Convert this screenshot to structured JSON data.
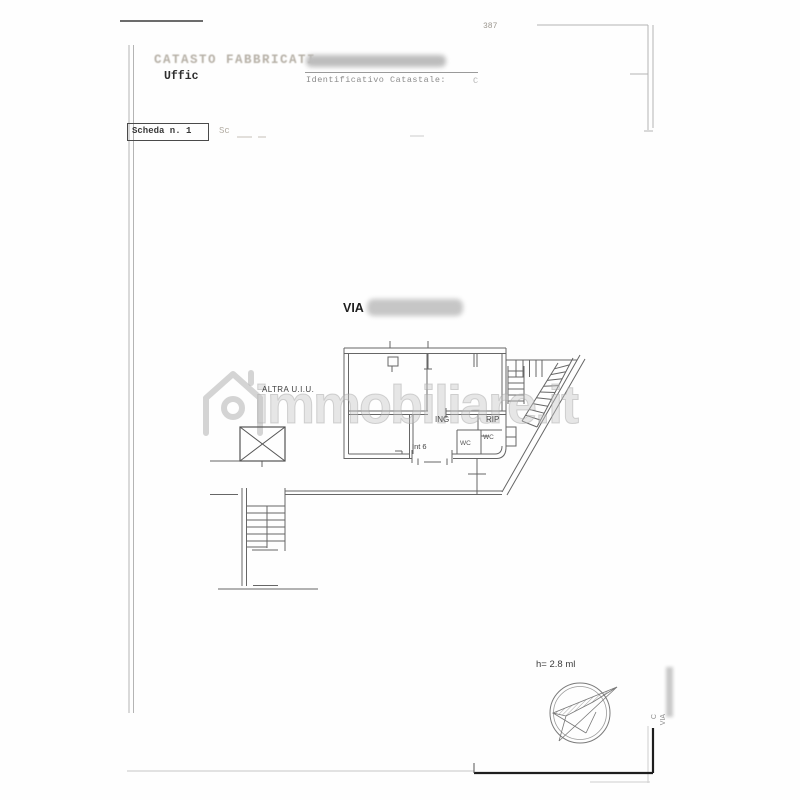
{
  "colors": {
    "plan_line": "#666666",
    "frame_line": "#b4b4b4",
    "bold_corner": "#1e1e1e",
    "watermark_gray": "#c5c5c5"
  },
  "header": {
    "page_number": "387",
    "registry_title": "CATASTO FABBRICATI",
    "office_prefix": "Uffic",
    "identifier_label": "Identificativo Catastale:",
    "identifier_stub": "C",
    "sheet_label": "Scheda n. 1",
    "sheet_stub": "Sc"
  },
  "plan": {
    "street_prefix": "VIA",
    "adjacent_unit_label": "ALTRA U.I.U.",
    "room_ing": "ING",
    "room_rip": "RIP",
    "room_wc_left": "WC",
    "room_wc_right": "WC",
    "unit_label": "Int 6",
    "height_note": "h= 2.8 ml"
  },
  "watermark": {
    "brand": "immobiliare.it"
  },
  "right_margin": {
    "label_1": "C",
    "label_2": "VIA"
  }
}
